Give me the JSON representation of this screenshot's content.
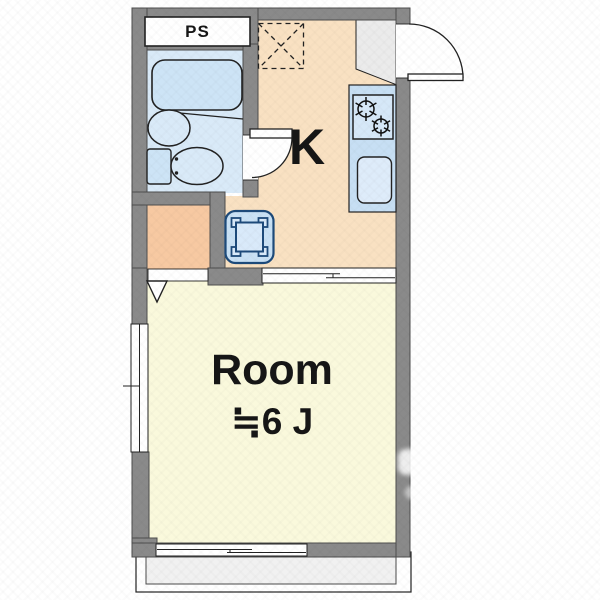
{
  "floorplan": {
    "labels": {
      "pipe_space": "PS",
      "kitchen": "K",
      "room_name": "Room",
      "room_size": "≒6 J"
    },
    "fixtures": [
      "bathtub",
      "wash-basin",
      "toilet",
      "bathroom-door",
      "gas-stove",
      "kitchen-sink",
      "kitchen-counter",
      "refrigerator-space",
      "washing-machine-pan",
      "entry-door",
      "genkan",
      "sliding-door",
      "closet-opening",
      "window-left",
      "window-bottom",
      "balcony",
      "pipe-space"
    ],
    "colors": {
      "wall": "#8A8A8A",
      "wall_line": "#4D4D4D",
      "line_dark": "#222222",
      "bathroom_floor": "#D9EAF8",
      "kitchen_floor": "#F9E1C2",
      "closet_floor": "#F7C9A2",
      "room_floor": "#FAF9DC",
      "genkan_floor": "#EBEBEB",
      "balcony_floor": "#F1F1F1",
      "counter_fill": "#C7DFF4",
      "stove_fill": "#D6E8F8",
      "sink_fill": "#DEECFA",
      "tub_fill": "#CDE4F6",
      "pan_fill": "#C9E1F5",
      "pan_inner_fill": "#D9EAFA",
      "pan_line": "#1D4A7A"
    }
  }
}
